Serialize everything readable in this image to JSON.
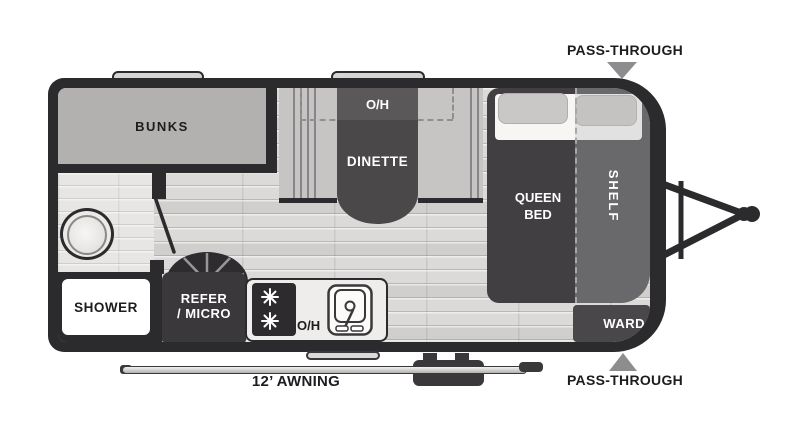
{
  "floorplan": {
    "type": "travel-trailer",
    "labels": {
      "bunks": "BUNKS",
      "dinette_oh": "O/H",
      "dinette": "DINETTE",
      "queen_bed": "QUEEN BED",
      "shelf": "SHELF",
      "ward": "WARD",
      "shower": "SHOWER",
      "refer_line1": "REFER",
      "refer_line2": "/ MICRO",
      "kitchen_oh": "O/H",
      "awning": "12’ AWNING",
      "pass_through_top": "PASS-THROUGH",
      "pass_through_bottom": "PASS-THROUGH"
    },
    "fixtures": [
      "toilet",
      "shower",
      "sink",
      "stove-2-burner",
      "refrigerator-microwave",
      "wheel",
      "entry-step",
      "hitch",
      "awning-rail",
      "windows",
      "queen-bed-with-pillows",
      "dinette-benches"
    ],
    "colors": {
      "wall": "#2b2a2c",
      "furniture_dark": "#4b4849",
      "bed_dark": "#413f42",
      "bench_gray": "#c7c5c3",
      "bunks_gray": "#b3b1af",
      "floor_light": "#dbdad8",
      "arrow_gray": "#8d8d8f",
      "label_text": "#1d1c1e"
    }
  }
}
